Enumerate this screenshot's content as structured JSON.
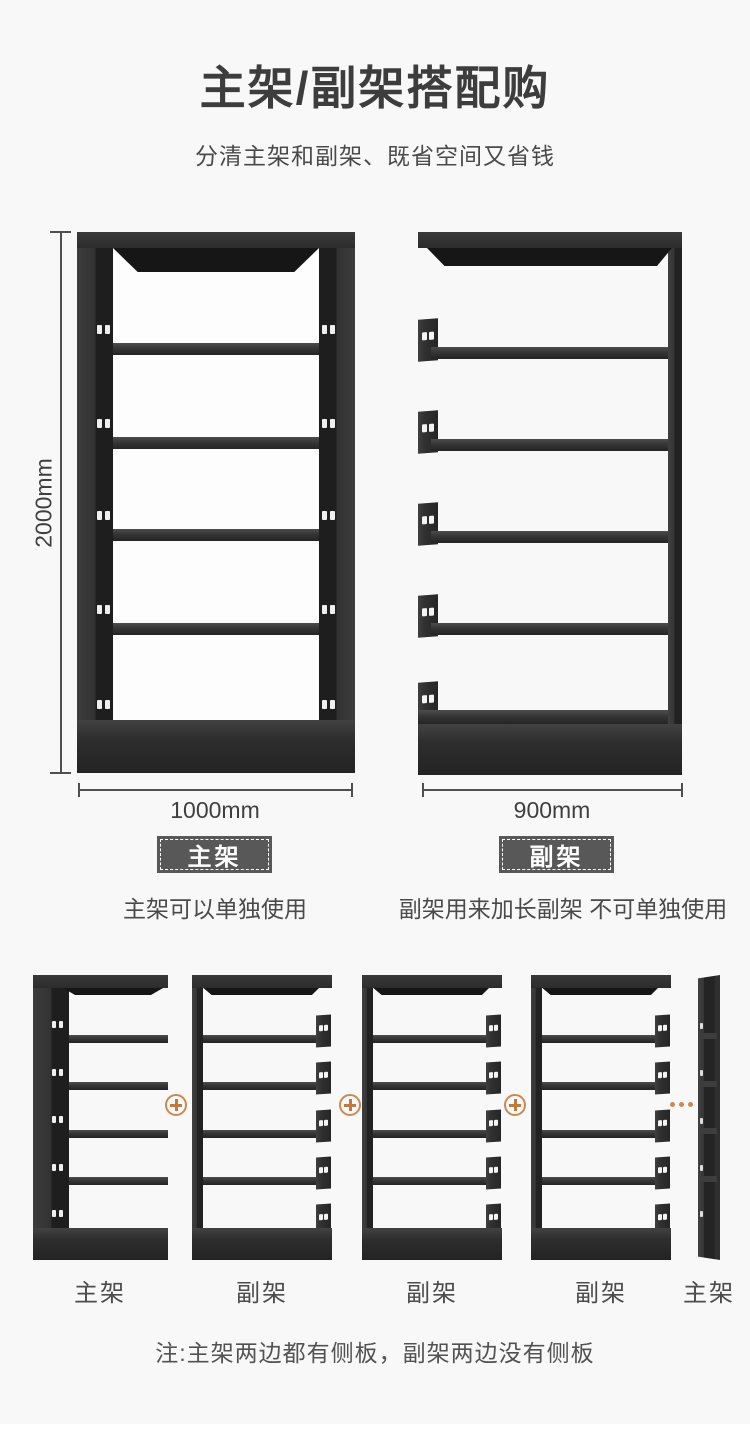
{
  "header": {
    "title": "主架/副架搭配购",
    "subtitle": "分清主架和副架、既省空间又省钱"
  },
  "comparison": {
    "main_shelf": {
      "badge": "主架",
      "height": "2000mm",
      "width": "1000mm",
      "description": "主架可以单独使用"
    },
    "sub_shelf": {
      "badge": "副架",
      "width": "900mm",
      "description": "副架用来加长副架 不可单独使用"
    }
  },
  "combination": {
    "units": [
      {
        "label": "主架",
        "type": "main"
      },
      {
        "label": "副架",
        "type": "sub"
      },
      {
        "label": "副架",
        "type": "sub"
      },
      {
        "label": "副架",
        "type": "sub"
      },
      {
        "label": "主架",
        "type": "main-side-panel"
      }
    ],
    "note": "注:主架两边都有侧板，副架两边没有侧板"
  },
  "icons": {
    "plus": "plus-in-circle",
    "ellipsis": "horizontal-dots"
  },
  "colors": {
    "background": "#f8f8f8",
    "shelf_dark": "#2e2e2e",
    "accent_orange": "#c98a52",
    "badge_background": "#585858",
    "text_primary": "#3d3d3d",
    "text_secondary": "#4a4a4a"
  }
}
